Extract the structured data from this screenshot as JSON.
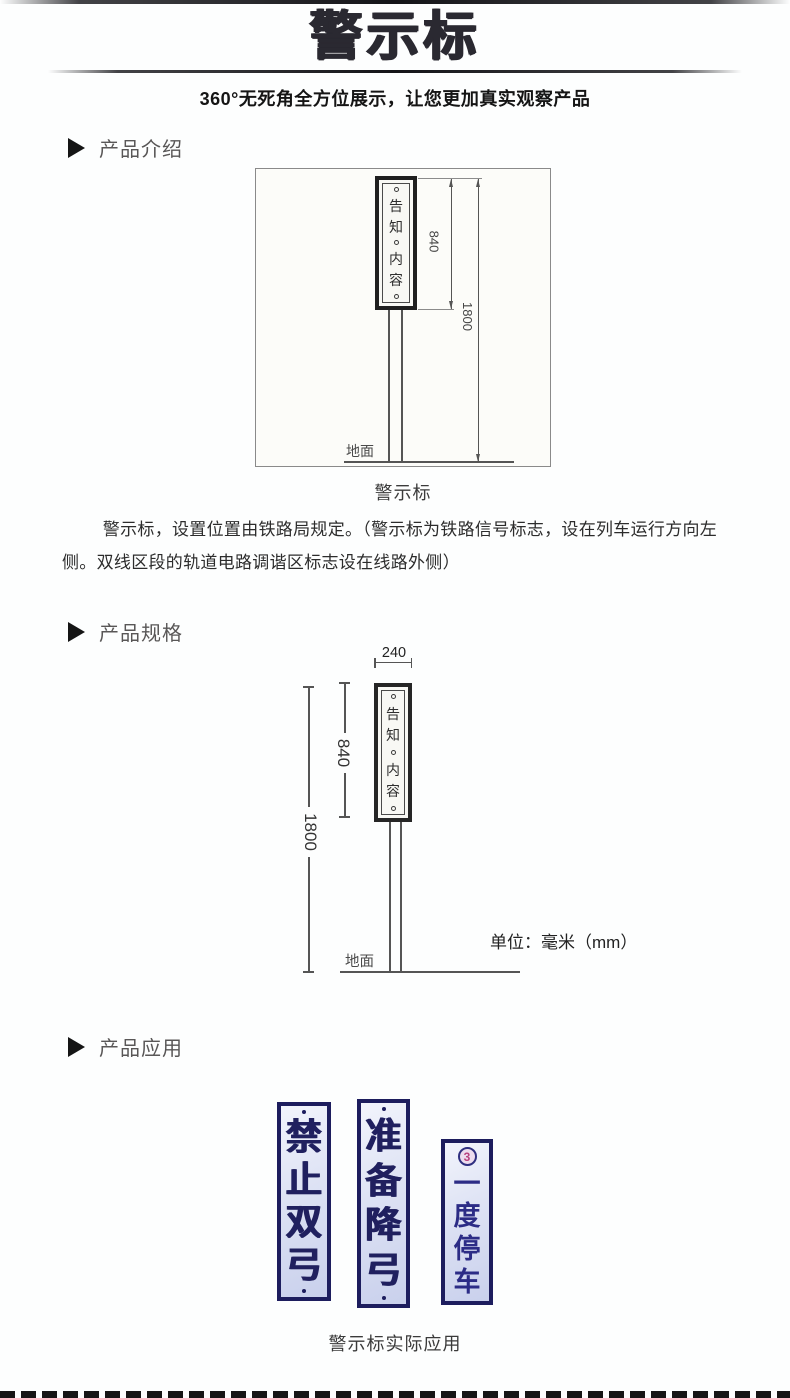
{
  "header": {
    "title": "警示标",
    "subtitle": "360°无死角全方位展示，让您更加真实观察产品"
  },
  "sections": {
    "intro": {
      "heading": "产品介绍"
    },
    "spec": {
      "heading": "产品规格"
    },
    "app": {
      "heading": "产品应用"
    }
  },
  "figure1": {
    "sign_chars": [
      "告",
      "知",
      "内",
      "容"
    ],
    "dims": {
      "sign_height": "840",
      "total_height": "1800"
    },
    "ground_label": "地面",
    "caption": "警示标"
  },
  "intro": {
    "paragraph": "警示标，设置位置由铁路局规定。（警示标为铁路信号标志，设在列车运行方向左侧。双线区段的轨道电路调谐区标志设在线路外侧）"
  },
  "figure2": {
    "sign_chars": [
      "告",
      "知",
      "内",
      "容"
    ],
    "dims": {
      "width": "240",
      "sign_height": "840",
      "total_height": "1800"
    },
    "ground_label": "地面",
    "unit_note": "单位：毫米（mm）"
  },
  "application": {
    "signs": [
      {
        "chars": [
          "禁",
          "止",
          "双",
          "弓"
        ]
      },
      {
        "chars": [
          "准",
          "备",
          "降",
          "弓"
        ]
      },
      {
        "chars": [
          "一",
          "度",
          "停",
          "车"
        ],
        "badge": "3"
      }
    ],
    "caption": "警示标实际应用"
  },
  "colors": {
    "title": "#2a2931",
    "heading-text": "#595757",
    "sign-navy": "#1d1d5e",
    "sign-char": "#20205f",
    "badge-pink": "#b8417f",
    "drawing-line": "#555555"
  }
}
